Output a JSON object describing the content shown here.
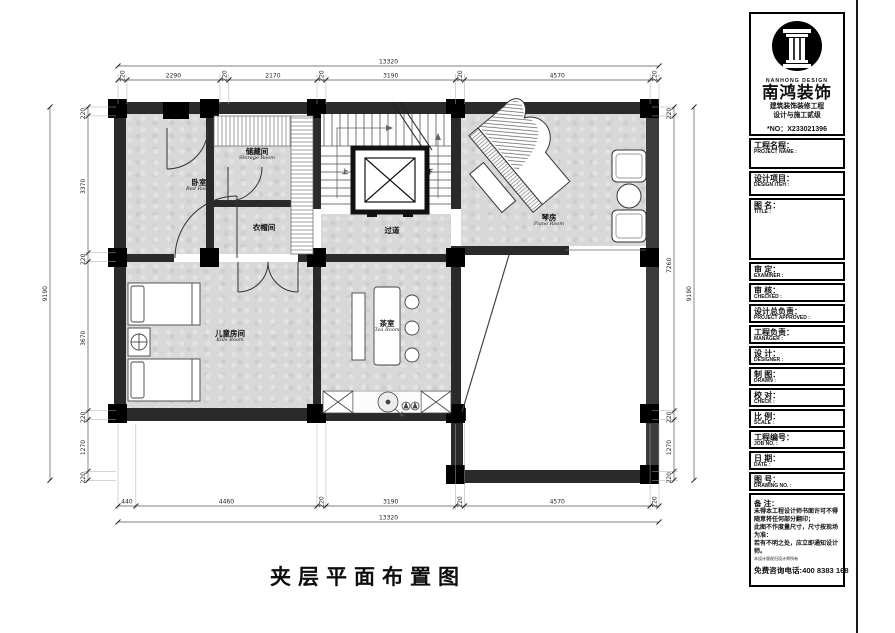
{
  "plan": {
    "drawing_title": "夹层平面布置图",
    "rooms": {
      "bedroom": {
        "cn": "卧室",
        "en": "Bed Room"
      },
      "storage": {
        "cn": "储藏间",
        "en": "Storage Room"
      },
      "cloak": {
        "cn": "衣帽间",
        "en": ""
      },
      "corridor": {
        "cn": "过道",
        "en": ""
      },
      "piano": {
        "cn": "琴房",
        "en": "Piano Room"
      },
      "kids": {
        "cn": "儿童房间",
        "en": "Kids Room"
      },
      "tea": {
        "cn": "茶室",
        "en": "Tea Room"
      },
      "stair_up": "上",
      "stair_down": "下"
    },
    "dimensions": {
      "top": {
        "total": 13320,
        "segments": [
          220,
          2290,
          220,
          2170,
          220,
          3190,
          220,
          4570,
          220
        ]
      },
      "bottom": {
        "total": 13320,
        "segments": [
          440,
          4460,
          220,
          3190,
          220,
          4570,
          220
        ]
      },
      "left": {
        "total": 9190,
        "segments": [
          220,
          3370,
          220,
          3670,
          220,
          1270,
          220
        ]
      },
      "right": {
        "total": 9190,
        "segments": [
          220,
          7260,
          220,
          1270,
          220
        ]
      }
    }
  },
  "title_block": {
    "logo": {
      "caption": "NANHONG DESIGN",
      "brand": "南鸿装饰",
      "line1": "建筑装饰装修工程",
      "line2": "设计与施工贰级",
      "license": "*NO：X233021396"
    },
    "fields": [
      {
        "cn": "工程名程：",
        "en": "PROJECT NAME :"
      },
      {
        "cn": "设计项目：",
        "en": "DESIGN ITEH :"
      },
      {
        "cn": "图 名：",
        "en": "TITLE :"
      },
      {
        "cn": "审 定：",
        "en": "EXAMINER :"
      },
      {
        "cn": "审 核：",
        "en": "CHECKED :"
      },
      {
        "cn": "设计总负责：",
        "en": "PROJECT APPROVED :"
      },
      {
        "cn": "工程负责：",
        "en": "MANAGER :"
      },
      {
        "cn": "设 计：",
        "en": "DESIGNER :"
      },
      {
        "cn": "制 图：",
        "en": "DRAWN :"
      },
      {
        "cn": "校 对：",
        "en": "CHECK :"
      },
      {
        "cn": "比 例：",
        "en": "SCALE :"
      },
      {
        "cn": "工程编号：",
        "en": "JOB NO. :"
      },
      {
        "cn": "日 期：",
        "en": "DATE :"
      },
      {
        "cn": "图 号：",
        "en": "DRAWING NO. :"
      }
    ],
    "notes": {
      "title": "备 注：",
      "lines": [
        "未得本工程设计师书面许可不得",
        "随意将任何部分翻印；",
        "此图不作度量尺寸，尺寸按现场",
        "为准：",
        "若有不明之处，应立即通知设计",
        "师。"
      ],
      "fine_print": "本设计版权归设计师所有",
      "phone": "免费咨询电话:400 8383 168"
    }
  }
}
